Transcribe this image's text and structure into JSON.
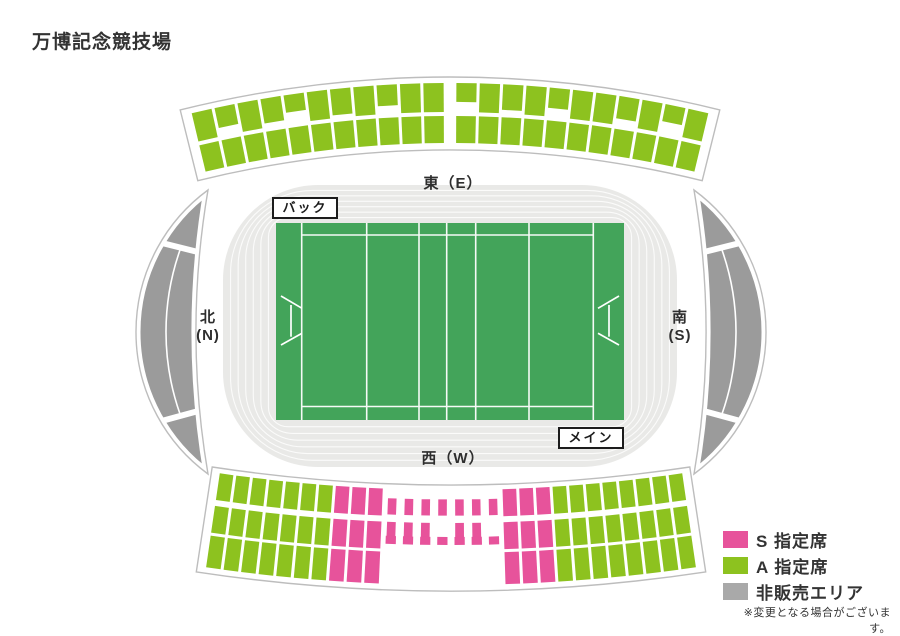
{
  "title": "万博記念競技場",
  "labels": {
    "east": "東（E）",
    "west": "西（W）",
    "north": [
      "北",
      "(N)"
    ],
    "south": [
      "南",
      "(S)"
    ],
    "back_stand": "バック",
    "main_stand": "メイン"
  },
  "legend": {
    "items": [
      {
        "code": "S",
        "label": "S 指定席",
        "color": "#e7539b"
      },
      {
        "code": "A",
        "label": "A 指定席",
        "color": "#8dc21f"
      },
      {
        "code": "U",
        "label": "非販売エリア",
        "color": "#a9a9a9"
      }
    ],
    "note": "※変更となる場合がございます。"
  },
  "colors": {
    "seat_a": "#8dc21f",
    "seat_s": "#e7539b",
    "unsold": "#9b9b9b",
    "field": "#43a45a",
    "track": "#e9e9e7",
    "field_line": "#ffffff",
    "outline": "#bdbdbd"
  },
  "stands": {
    "back": {
      "cx": 450,
      "cy": 1200,
      "dir": -1,
      "outline": {
        "r_in": 1050,
        "r_out": 1123,
        "half_deg": 13.9
      },
      "block_half_deg": 13.45,
      "gap_px": 3,
      "aisle_after": 10,
      "aisle_deg": 0.5,
      "rows": [
        {
          "r_in": 1088,
          "r_out": 1117,
          "cols": [
            "A",
            "A",
            "A",
            "A",
            "A",
            "A",
            "A",
            "A",
            "A",
            "A",
            "A",
            "A",
            "A",
            "A",
            "A",
            "A",
            "A",
            "A",
            "A",
            "A",
            "A",
            "A"
          ],
          "heights": [
            1,
            0.7,
            1,
            0.85,
            0.6,
            1,
            0.9,
            1,
            0.72,
            1,
            1,
            0.65,
            1,
            0.88,
            1,
            0.7,
            1,
            1,
            0.78,
            1,
            0.6,
            1
          ]
        },
        {
          "r_in": 1057,
          "r_out": 1084,
          "cols": [
            "A",
            "A",
            "A",
            "A",
            "A",
            "A",
            "A",
            "A",
            "A",
            "A",
            "A",
            "A",
            "A",
            "A",
            "A",
            "A",
            "A",
            "A",
            "A",
            "A",
            "A",
            "A"
          ]
        }
      ]
    },
    "main": {
      "cx": 451,
      "cy": -1112,
      "dir": 1,
      "outline": {
        "r_in": 1597,
        "r_out": 1703,
        "half_deg": 8.6
      },
      "block_half_deg": 8.35,
      "gap_px": 3,
      "rows": [
        {
          "r_in": 1602,
          "r_out": 1629,
          "small_radial": [
            0.35,
            0.95
          ],
          "small_ang": 0.62,
          "cols": [
            "A",
            "A",
            "A",
            "A",
            "A",
            "A",
            "A",
            "S",
            "S",
            "S",
            "s",
            "s",
            "s",
            "s",
            "s",
            "s",
            "s",
            "S",
            "S",
            "S",
            "A",
            "A",
            "A",
            "A",
            "A",
            "A",
            "A",
            "A"
          ]
        },
        {
          "r_in": 1635,
          "r_out": 1662,
          "small_radial": [
            0,
            0.55
          ],
          "small_ang": 0.62,
          "cols": [
            "A",
            "A",
            "A",
            "A",
            "A",
            "A",
            "A",
            "S",
            "S",
            "S",
            "s",
            "s",
            "s",
            "",
            "s",
            "s",
            "",
            "S",
            "S",
            "S",
            "A",
            "A",
            "A",
            "A",
            "A",
            "A",
            "A",
            "A"
          ]
        },
        {
          "r_in": 1649,
          "r_out": 1657,
          "small_radial": [
            0,
            1
          ],
          "small_ang": 0.72,
          "cols": [
            "",
            "",
            "",
            "",
            "",
            "",
            "",
            "",
            "",
            "",
            "d",
            "d",
            "d",
            "d",
            "d",
            "d",
            "d",
            "d",
            "d",
            "",
            "",
            "",
            "",
            "",
            "",
            "",
            "",
            ""
          ]
        },
        {
          "r_in": 1665,
          "r_out": 1697,
          "cols": [
            "A",
            "A",
            "A",
            "A",
            "A",
            "A",
            "A",
            "S",
            "S",
            "S",
            "",
            "",
            "",
            "",
            "",
            "",
            "",
            "S",
            "S",
            "S",
            "A",
            "A",
            "A",
            "A",
            "A",
            "A",
            "A",
            "A"
          ]
        }
      ]
    }
  }
}
